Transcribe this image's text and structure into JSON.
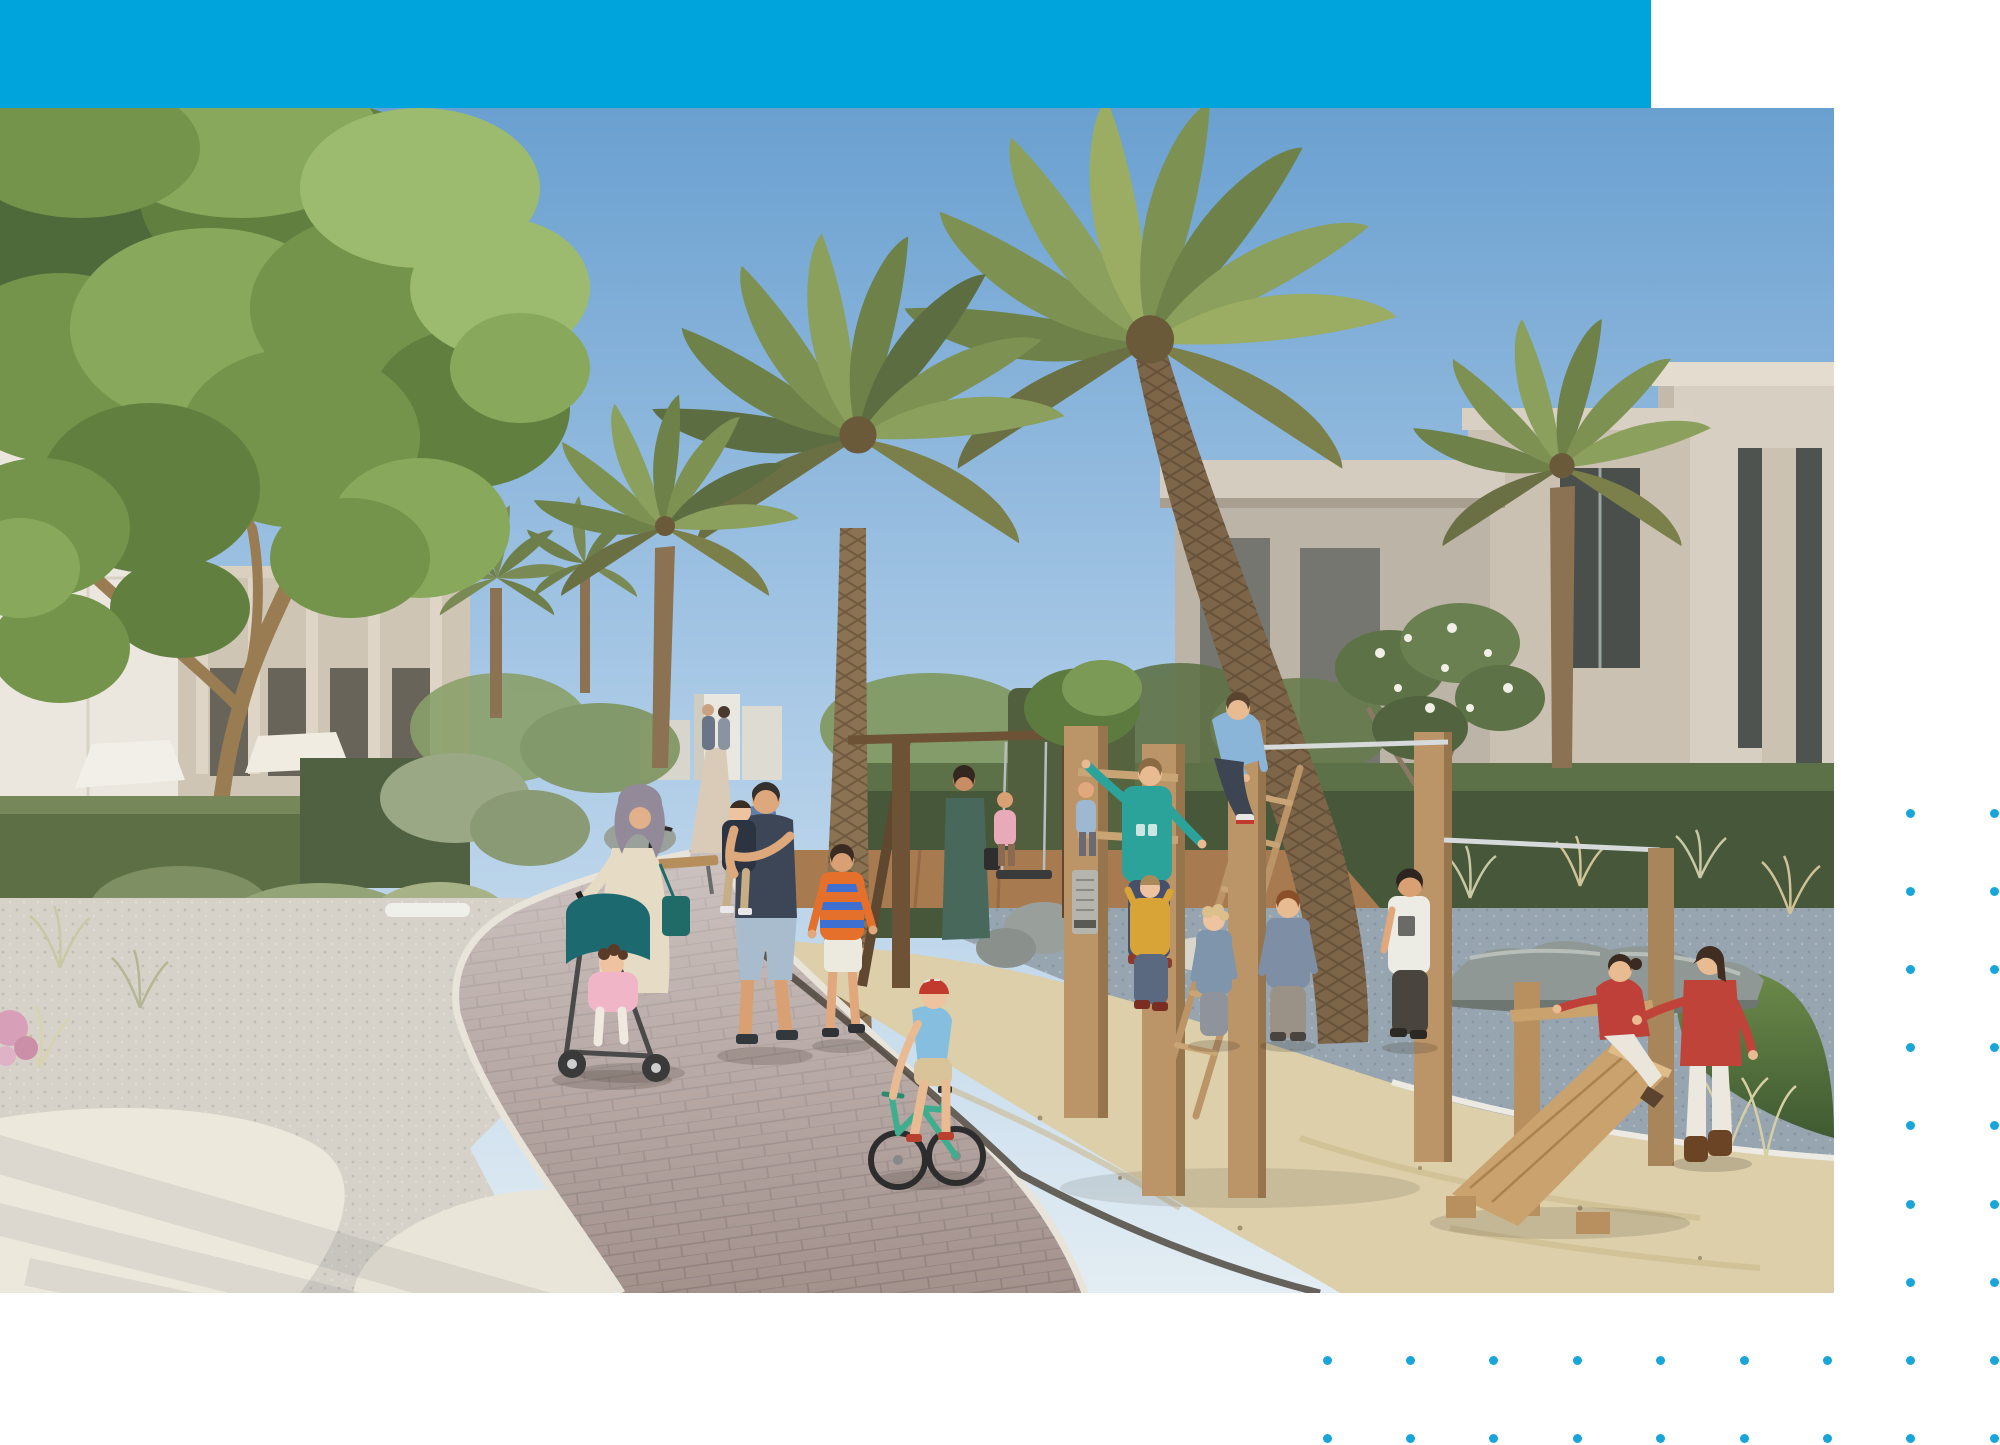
{
  "meta": {
    "page_type": "brochure page with full-bleed architectural rendering",
    "visible_text": "none"
  },
  "theme": {
    "page_bg": "#ffffff",
    "accent_bar": "#00a4dc",
    "dot_color": "#18a5da",
    "sky_top": "#6aa0d0",
    "sky_mid": "#a9c9e6",
    "sky_bottom": "#e3edf3",
    "sand": "#dccfa9",
    "path_brick": "#a3918c",
    "path_curb": "#e9e4da",
    "gravel_light": "#d6d2c9",
    "gravel_blue": "#97a5b1",
    "concrete": "#ece8dc",
    "timber": "#bb9468",
    "timber_dark": "#6e5236",
    "hedge_dark": "#47573a",
    "hedge_mid": "#5d6f45",
    "foliage_green": "#74944b",
    "lawn": "#5d7a40",
    "building_left": "#cfc5b5",
    "building_right": "#cac1b2",
    "building_white": "#ece7de",
    "palm_trunk": "#7c6548"
  },
  "layout_rects": {
    "header_bar": {
      "x": 0,
      "y": 0,
      "w": 1651,
      "h": 108
    },
    "photo": {
      "x": 0,
      "y": 108,
      "w": 1834,
      "h": 1185
    }
  },
  "decor": {
    "dot_size": 9,
    "dot_groups": [
      {
        "name": "right-two-columns",
        "origin_x": 1910.8,
        "origin_y": 813,
        "cols": 2,
        "rows": 7,
        "dx": 83.4,
        "dy": 78.2
      },
      {
        "name": "bottom-grid",
        "origin_x": 1327,
        "origin_y": 1360.4,
        "cols": 9,
        "rows": 2,
        "dx": 83.4,
        "dy": 78.2
      }
    ]
  },
  "photo_content": {
    "alt": "Rendering of a landscaped community park between modern villas: date palms and a large leafy tree, clipped hedges, a curving brick path with white curbs, white gravel and sand play areas, timber climbing frame and ramp, and families with children playing.",
    "elements": [
      {
        "name": "sky",
        "description": "clear blue sky, lighter at horizon"
      },
      {
        "name": "left-buildings",
        "description": "white and greige low-rise facades with dark window slits and shade canopies"
      },
      {
        "name": "right-building",
        "description": "large beige flat-roofed villa with parapet bands and vertical dark glazing"
      },
      {
        "name": "big-left-tree",
        "description": "multi-trunk leafy green tree filling the upper left"
      },
      {
        "name": "palms",
        "description": "several date palms with textured trunks in center and right"
      },
      {
        "name": "frangipani-tree",
        "description": "small tree with white flowers in front of right building"
      },
      {
        "name": "hedges",
        "description": "dark clipped hedge bands and rounded bushes with ornamental grasses"
      },
      {
        "name": "path",
        "description": "curved mauve brick walkway with pale stone curbs"
      },
      {
        "name": "play-areas",
        "description": "sand pit, blue-grey gravel, boulders, timber climbing frame, swing and wooden ramp"
      }
    ],
    "people": [
      {
        "name": "woman-with-hijab",
        "clothing": "cream floral dress, grey hijab, teal tote, pushing teal stroller"
      },
      {
        "name": "toddler-in-stroller",
        "clothing": "pink jacket, white pants, dark curly hair"
      },
      {
        "name": "man-carrying-toddler",
        "clothing": "navy t-shirt, light denim shorts; toddler in dark top and khaki pants"
      },
      {
        "name": "boy-striped-shirt",
        "clothing": "orange and blue striped tee, white shorts"
      },
      {
        "name": "child-on-balance-bike",
        "clothing": "red helmet, light blue tee, beige shorts, mint green bike"
      },
      {
        "name": "boy-on-post-top",
        "clothing": "light blue hoodie, dark jeans"
      },
      {
        "name": "boy-teal-sweater",
        "clothing": "teal long sleeve, dark jeans, climbing ladder"
      },
      {
        "name": "toddler-yellow-top",
        "clothing": "mustard top, blue jeans"
      },
      {
        "name": "blond-toddler",
        "clothing": "grey-blue top, grey pants"
      },
      {
        "name": "boy-grey-tee",
        "clothing": "grey-blue tee, taupe pants"
      },
      {
        "name": "boy-white-tee",
        "clothing": "white graphic tee, dark pants"
      },
      {
        "name": "girl-on-ramp",
        "clothing": "red sweater, white pants, kneeling on wooden ramp"
      },
      {
        "name": "girl-standing-right",
        "clothing": "red top, white pants, brown boots"
      },
      {
        "name": "background-walker",
        "clothing": "blue shirt, dark trousers"
      },
      {
        "name": "background-group",
        "clothing": "woman in dark green dress with two small children"
      },
      {
        "name": "distant-couple",
        "clothing": "tiny figures on far path"
      }
    ]
  }
}
